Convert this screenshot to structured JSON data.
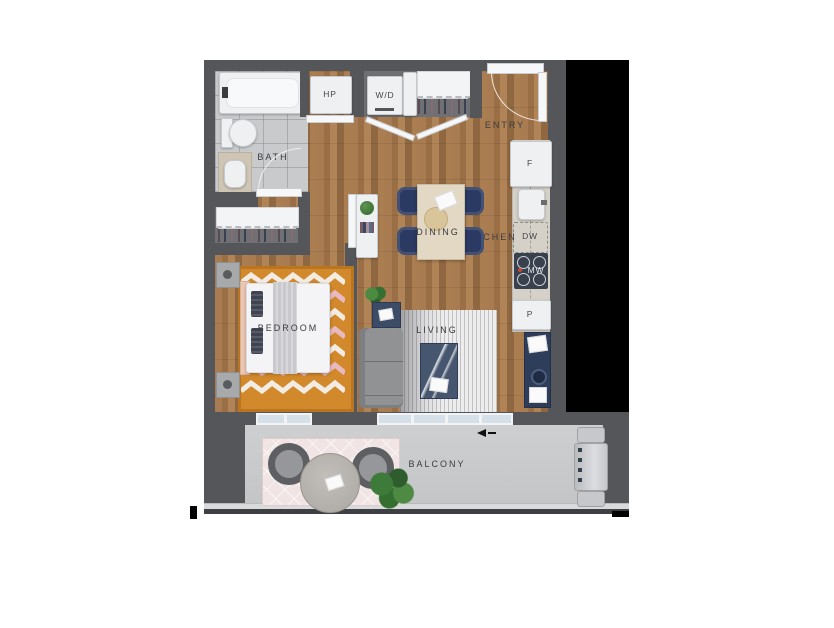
{
  "rooms": {
    "bath": {
      "label": "BATH"
    },
    "entry": {
      "label": "ENTRY"
    },
    "kitchen": {
      "label": "KITCHEN"
    },
    "dining": {
      "label": "DINING"
    },
    "bedroom": {
      "label": "BEDROOM"
    },
    "living": {
      "label": "LIVING"
    },
    "balcony": {
      "label": "BALCONY"
    }
  },
  "fixtures": {
    "hp": {
      "label": "HP"
    },
    "wd": {
      "label": "W/D"
    },
    "fridge": {
      "label": "F"
    },
    "dw": {
      "label": "DW"
    },
    "mw": {
      "label": "MW"
    },
    "pantry": {
      "label": "P"
    }
  },
  "colors": {
    "wall": "#55565a",
    "black": "#000000",
    "tile": "#c9cacc",
    "closetFloor": "#6f7074",
    "counter": "#d5d1c8",
    "appliance": "#eef0f2",
    "navy": "#2b3a63",
    "cooktop": "#39414e",
    "tableWood": "#e2d8c4",
    "rugOrange": "#d2892b",
    "rugPink": "#e8b9c0",
    "bedWhite": "#f4f4f6",
    "sofa": "#909294",
    "concrete": "#c7c9ca",
    "balconyRug": "#f0e4e4",
    "label": "#3b3b40"
  }
}
